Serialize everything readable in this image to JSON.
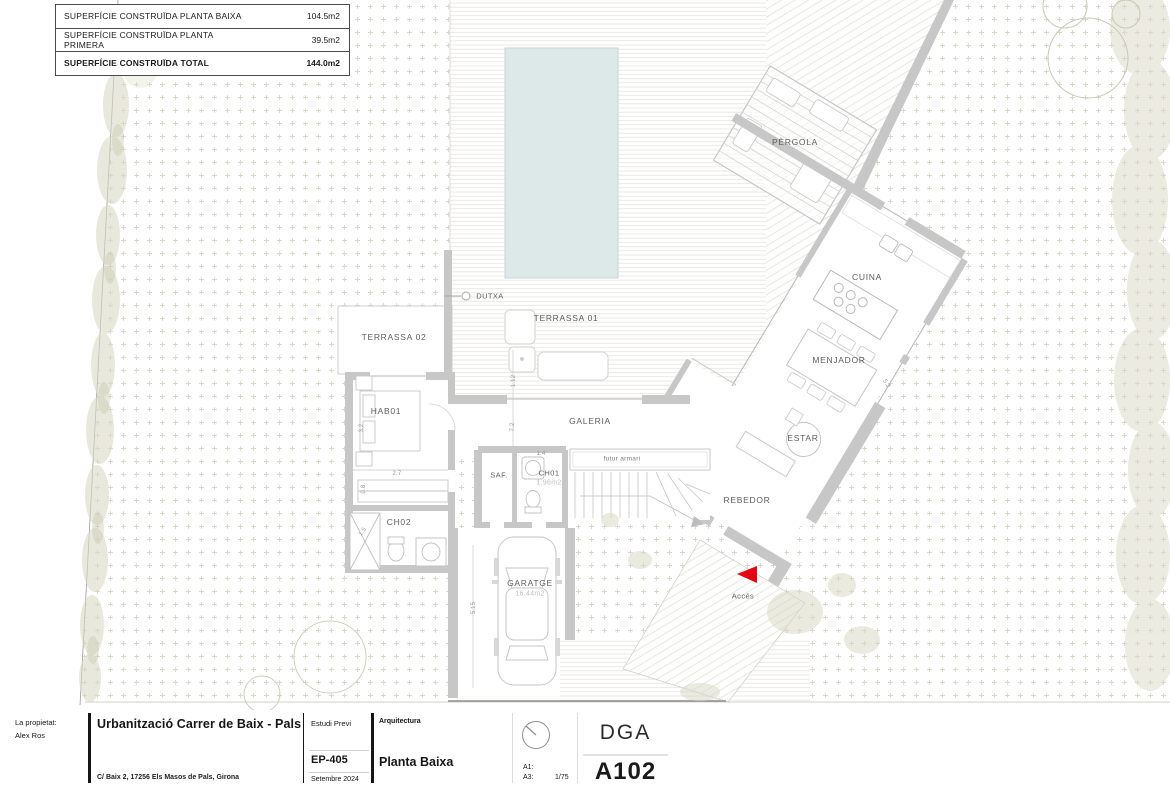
{
  "area_table": {
    "rows": [
      {
        "label": "SUPERFÍCIE CONSTRUÏDA PLANTA BAIXA",
        "value": "104.5m2"
      },
      {
        "label": "SUPERFÍCIE CONSTRUÏDA PLANTA PRIMERA",
        "value": "39.5m2"
      },
      {
        "label": "SUPERFÍCIE CONSTRUÏDA TOTAL",
        "value": "144.0m2"
      }
    ]
  },
  "plan": {
    "rooms": {
      "pergola": "PÈRGOLA",
      "cuina": "CUINA",
      "menjador": "MENJADOR",
      "estar": "ESTAR",
      "rebedor": "REBEDOR",
      "acces": "Accés",
      "galeria": "GALERIA",
      "terrassa01": "TERRASSA 01",
      "terrassa02": "TERRASSA 02",
      "hab01": "HAB01",
      "ch02": "CH02",
      "ch01": "CH01",
      "saf": "SAF.",
      "garatge": "GARATGE",
      "dutxa": "DUTXA",
      "futur_armari": "futur armari"
    },
    "areas": {
      "ch01": "1.96m2",
      "garatge": "16.44m2"
    },
    "dims": {
      "d27": "2.7",
      "d14": "1.4",
      "d32": "3.2",
      "d08": "0.8",
      "d15": "1.5",
      "d515": "5.15",
      "d72": "7.2",
      "d112": "1.12",
      "d52": "5.2"
    },
    "colors": {
      "pool": "#dde9e8",
      "wall": "#c7c7c7",
      "accent_red": "#e30613",
      "vegetation": "#d9d9c6"
    }
  },
  "titleblock": {
    "owner_label": "La propietat:",
    "owner_name": "Alex Ros",
    "project_title": "Urbanització Carrer de Baix - Pals",
    "project_address": "C/ Baix 2, 17256 Els Masos de Pals, Girona",
    "phase": "Estudi Previ",
    "code": "EP-405",
    "date": "Setembre 2024",
    "discipline": "Arquitectura",
    "sheet_title": "Planta Baixa",
    "scale_a1_label": "A1:",
    "scale_a3_label": "A3:",
    "scale_a3_value": "1/75",
    "studio": "DGA",
    "sheet_number": "A102"
  },
  "signature": {
    "text": "Alex Ros"
  }
}
